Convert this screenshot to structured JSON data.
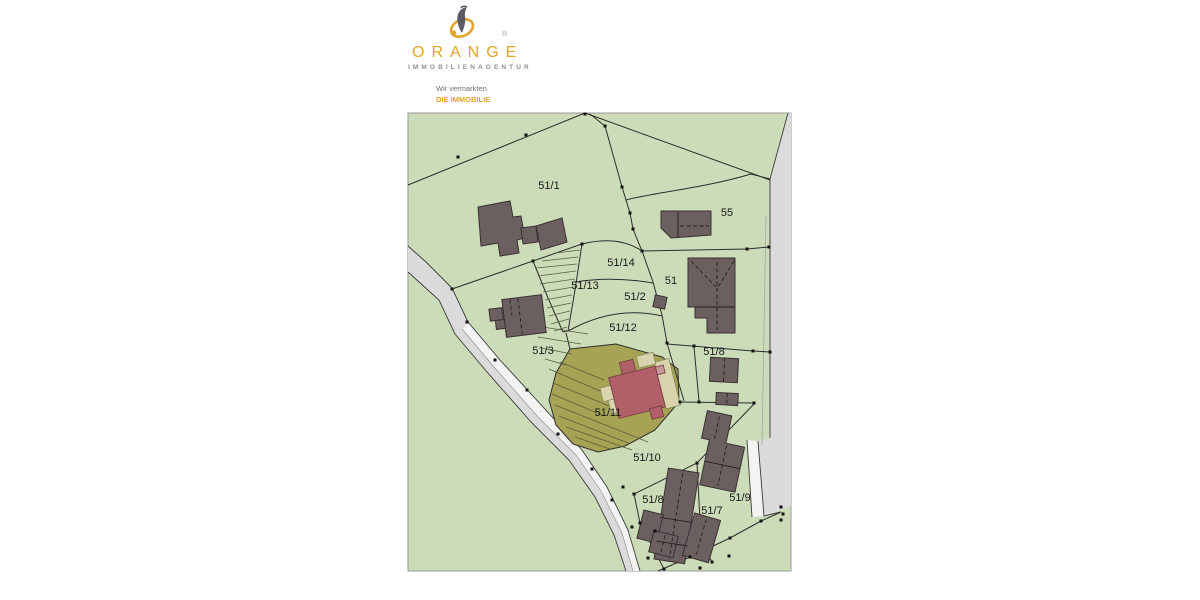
{
  "logo": {
    "brand": "ORANGE",
    "sub": "IMMOBILIENAGENTUR",
    "registered": "®",
    "tagline_1": "Wir vermarkten",
    "tagline_2": "DIE IMMOBILIE"
  },
  "map": {
    "type": "cadastral-site-plan",
    "highlighted_parcel": "51/11",
    "parcels": [
      {
        "label": "51/1"
      },
      {
        "label": "55"
      },
      {
        "label": "51/14"
      },
      {
        "label": "51/13"
      },
      {
        "label": "51/2"
      },
      {
        "label": "51"
      },
      {
        "label": "51/12"
      },
      {
        "label": "51/3"
      },
      {
        "label": "51/8"
      },
      {
        "label": "51/11"
      },
      {
        "label": "51/10"
      },
      {
        "label": "51/8"
      },
      {
        "label": "51/7"
      },
      {
        "label": "51/9"
      }
    ],
    "colors": {
      "parcel_green": "#cddcb8",
      "road_gray": "#dbdbdb",
      "sidewalk_white": "#f3f3f1",
      "building_dark": "#6c5f60",
      "highlight_olive": "#a6a355",
      "main_building_red": "#b16069",
      "annex_beige": "#d9d3ae",
      "boundary_line": "#2d2d2d",
      "logo_gold": "#e2a52b",
      "logo_gray": "#8f8f9b"
    }
  }
}
